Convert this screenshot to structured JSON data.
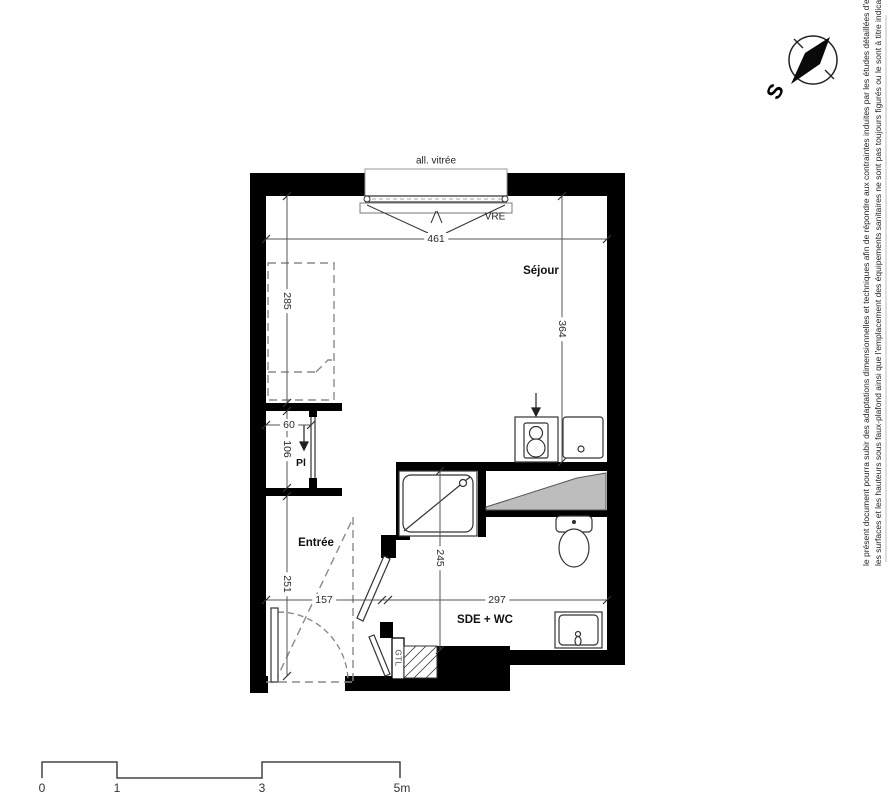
{
  "plan": {
    "window": {
      "label": "all. vitrée",
      "type_code": "VRE"
    },
    "rooms": {
      "sejour": "Séjour",
      "entree": "Entrée",
      "closet": "Pl",
      "bathroom": "SDE + WC",
      "duct": "GTL"
    },
    "dimensions_cm": {
      "sejour_width": "461",
      "sejour_depth": "364",
      "bed_zone_length": "285",
      "closet_width": "60",
      "closet_depth": "106",
      "entree_length": "251",
      "entree_width": "157",
      "bathroom_width": "297",
      "bathroom_depth": "245"
    }
  },
  "compass": {
    "south_label": "S"
  },
  "scale_bar": {
    "tick_0": "0",
    "tick_1": "1",
    "tick_3": "3",
    "tick_5": "5m"
  },
  "disclaimer": {
    "line_1": "le présent document pourra subir des adaptations dimensionnelles et techniques afin de répondre aux contraintes induites par les études détaillées d'exécution",
    "line_2": "les surfaces et les hauteurs sous faux-plafond ainsi que l'emplacement des équipements sanitaires ne sont pas toujours figurés ou le sont à titre indicatif."
  },
  "colors": {
    "wall": "#000000",
    "line": "#3c3c3c",
    "dashed": "#8a8a8a",
    "gray_zone": "#bdbdbd"
  }
}
